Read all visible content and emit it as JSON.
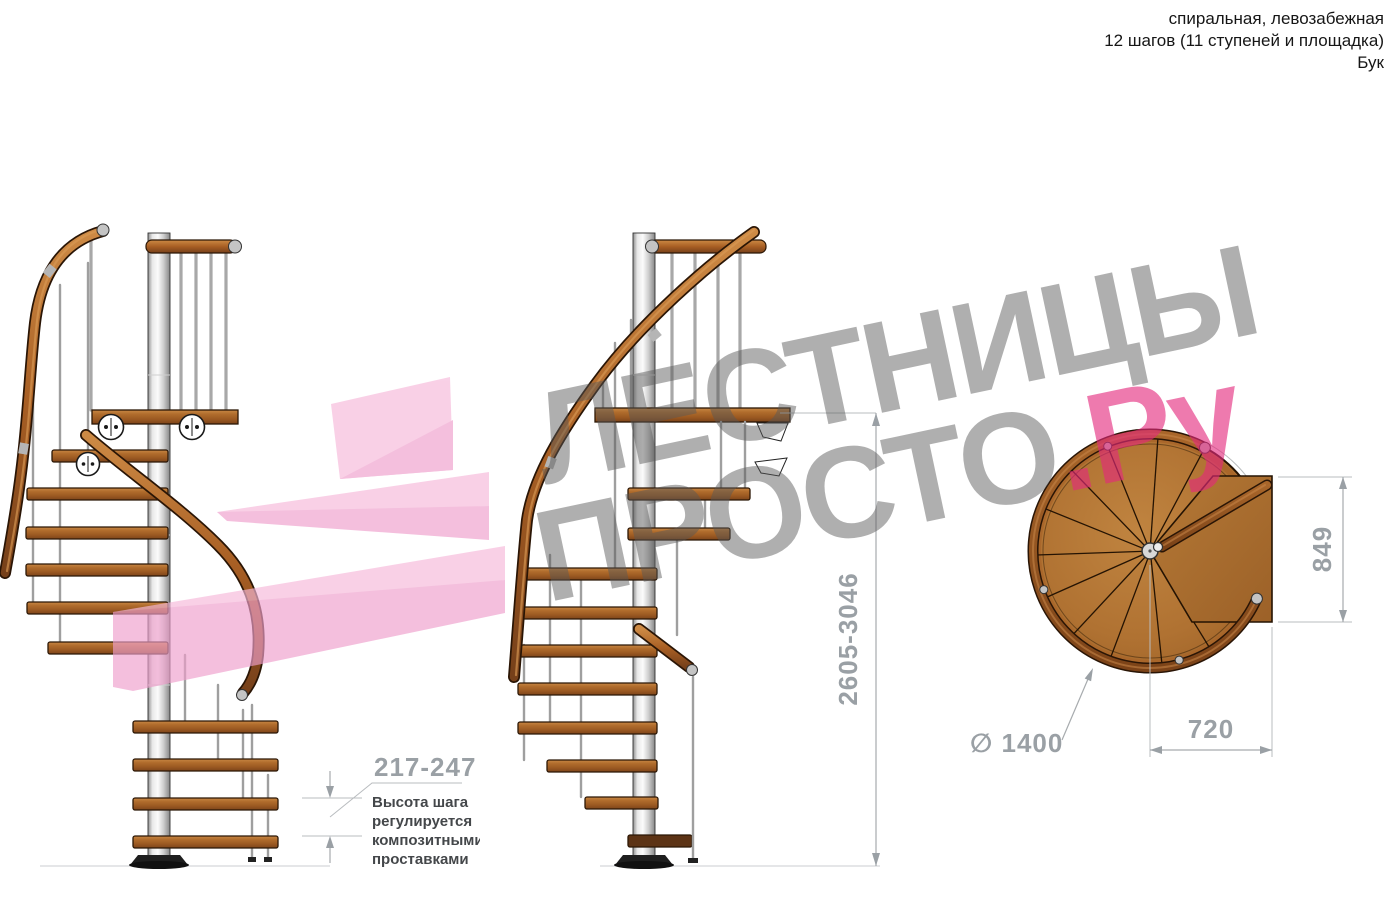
{
  "header": {
    "lines": [
      "спиральная, левозабежная",
      "12 шагов (11 ступеней и площадка)",
      "Бук"
    ]
  },
  "watermark": {
    "line1": "ЛЕСТНИЦЫ",
    "line2_gray": "ПРОСТО",
    "line2_accent": ".Ру"
  },
  "dims": {
    "step_height": "217-247",
    "note": [
      "Высота шага",
      "регулируется",
      "композитными",
      "проставками"
    ],
    "total_height": "2605-3046",
    "plan_depth": "849",
    "plan_width": "720",
    "diameter": "∅ 1400"
  },
  "colors": {
    "watermark_gray": "#9c9c9c",
    "watermark_pink": "#e8368c",
    "logo_pink_light": "#f6b9da",
    "logo_pink_mid": "#ef9fcc",
    "wood": "#a96328",
    "handrail": "#8f4f1e",
    "pole": "#d9d9d9",
    "dimension_gray": "#9aa0a5"
  }
}
